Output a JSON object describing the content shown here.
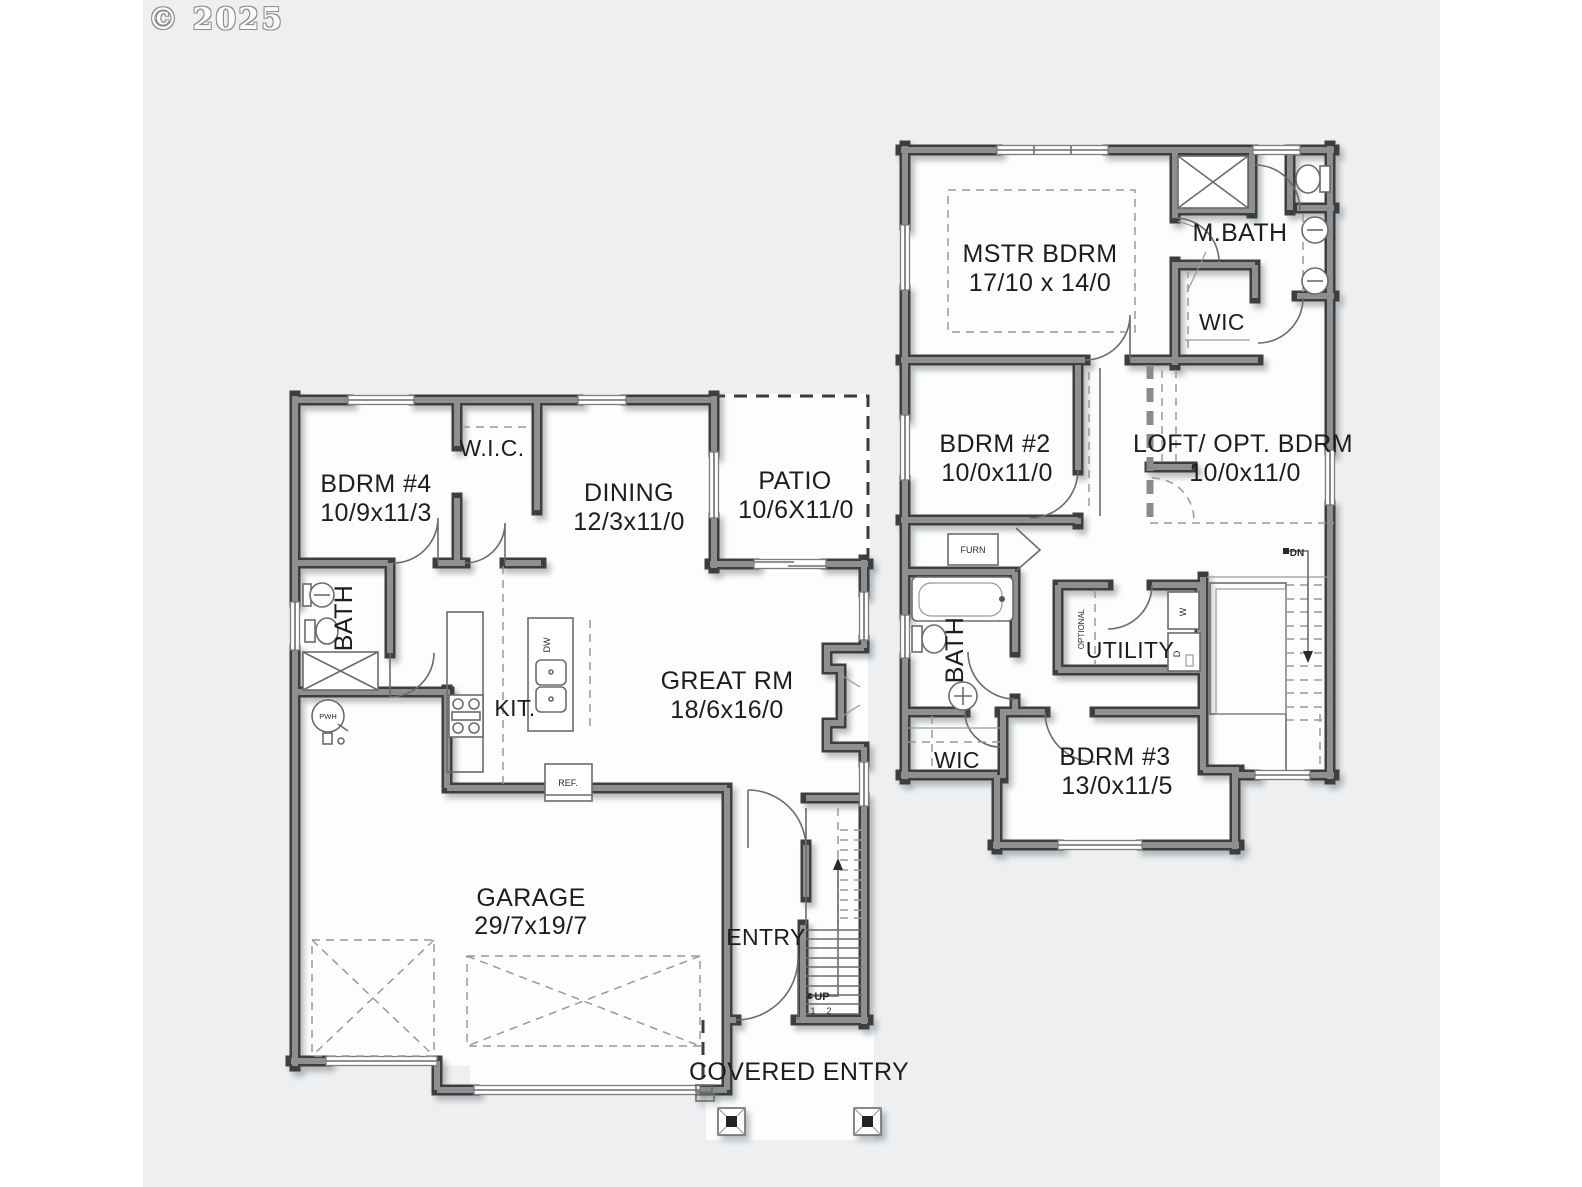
{
  "copyright": "© 2025",
  "colors": {
    "background": "#edeff1",
    "paper": "#fdfdfd",
    "wall_dark": "#3e3e3e",
    "wall_fill": "#8f8f8f",
    "line": "#6b6b6b",
    "text": "#1d1d1d"
  },
  "first_floor": {
    "bdrm4": {
      "name": "BDRM #4",
      "dims": "10/9x11/3"
    },
    "wic": {
      "name": "W.I.C."
    },
    "dining": {
      "name": "DINING",
      "dims": "12/3x11/0"
    },
    "patio": {
      "name": "PATIO",
      "dims": "10/6X11/0"
    },
    "bath": {
      "name": "BATH"
    },
    "kitchen": {
      "name": "KIT."
    },
    "great_room": {
      "name": "GREAT RM",
      "dims": "18/6x16/0"
    },
    "garage": {
      "name": "GARAGE",
      "dims": "29/7x19/7"
    },
    "entry": {
      "name": "ENTRY"
    },
    "covered_entry": {
      "name": "COVERED ENTRY"
    },
    "stair_direction": "UP",
    "step_numbers": [
      "1",
      "2"
    ],
    "refrigerator": "REF.",
    "dishwasher": "DW",
    "water_heater": "PWH"
  },
  "second_floor": {
    "master_bedroom": {
      "name": "MSTR BDRM",
      "dims": "17/10 x 14/0"
    },
    "master_bath": {
      "name": "M.BATH"
    },
    "master_wic": {
      "name": "WIC"
    },
    "bdrm2": {
      "name": "BDRM #2",
      "dims": "10/0x11/0"
    },
    "loft": {
      "name": "LOFT/ OPT. BDRM",
      "dims": "10/0x11/0"
    },
    "furnace": "FURN",
    "bath": {
      "name": "BATH"
    },
    "utility": {
      "name": "UTILITY"
    },
    "optional": "OPTIONAL",
    "washer": "W",
    "dryer": "D",
    "wic3": {
      "name": "WIC"
    },
    "bdrm3": {
      "name": "BDRM #3",
      "dims": "13/0x11/5"
    },
    "stair_direction": "DN"
  }
}
